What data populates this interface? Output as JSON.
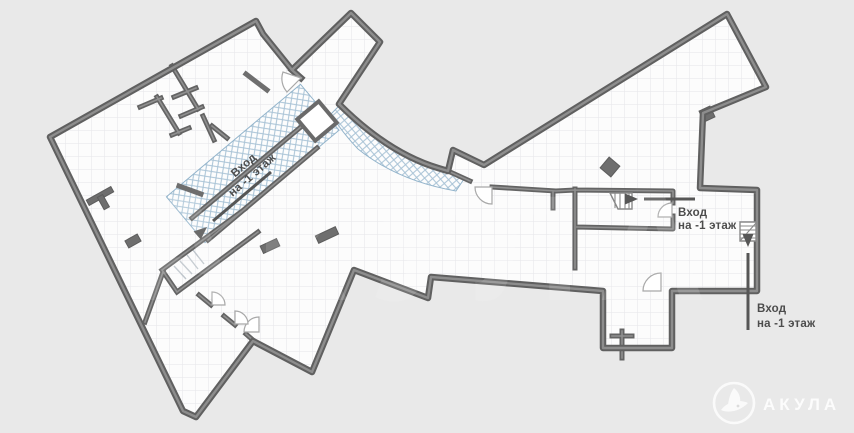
{
  "plan": {
    "kind": "basement-floor-plan",
    "floor_label": "-1",
    "colors": {
      "exterior_background": "#e9e9e9",
      "floor_fill": "#fcfcfc",
      "grid_line": "#e5e5e9",
      "wall_dark": "#606060",
      "wall_light": "#8d8d8d",
      "escalator_hatch": "#a9c3d6",
      "annotation_text": "#4c4c4c",
      "arrow": "#565656",
      "logo": "#ffffff"
    },
    "labels": {
      "escalator": {
        "line1": "Вход",
        "line2": "на -1 этаж"
      },
      "stairs_mid": {
        "line1": "Вход",
        "line2": "на -1 этаж"
      },
      "stairs_right": {
        "line1": "Вход",
        "line2": "на -1 этаж"
      }
    }
  },
  "branding": {
    "logo_text": "АКУЛА"
  },
  "watermark_text": "АКУЛА"
}
